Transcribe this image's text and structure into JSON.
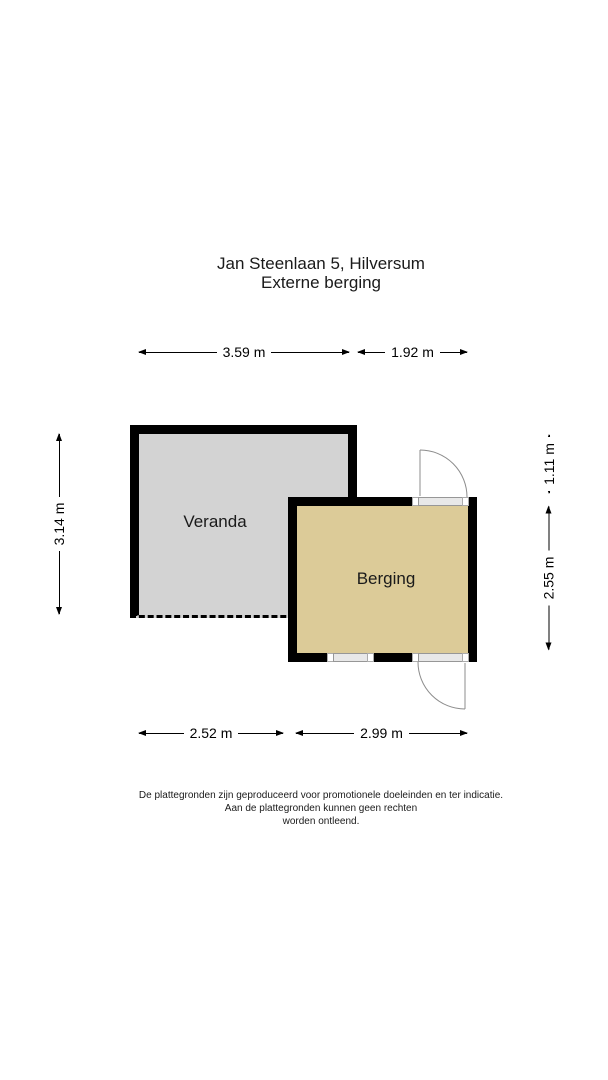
{
  "title": {
    "line1": "Jan Steenlaan 5, Hilversum",
    "line2": "Externe berging"
  },
  "rooms": [
    {
      "label": "Veranda",
      "fill": "#d3d3d3"
    },
    {
      "label": "Berging",
      "fill": "#dccb98"
    }
  ],
  "dimensions": {
    "top_width_veranda": "3.59 m",
    "top_width_berging": "1.92 m",
    "left_height_veranda": "3.14 m",
    "right_height_offset": "1.11 m",
    "right_height_berging": "2.55 m",
    "bottom_width_veranda": "2.52 m",
    "bottom_width_berging": "2.99 m"
  },
  "footer": {
    "line1": "De plattegronden zijn geproduceerd voor promotionele doeleinden en ter indicatie.",
    "line2": "Aan de plattegronden kunnen geen rechten",
    "line3": "worden ontleend."
  },
  "colors": {
    "wall": "#000000",
    "veranda_fill": "#d3d3d3",
    "berging_fill": "#dccb98",
    "door_arc": "#8c8c8c",
    "background": "#ffffff",
    "text": "#1a1a1a"
  }
}
